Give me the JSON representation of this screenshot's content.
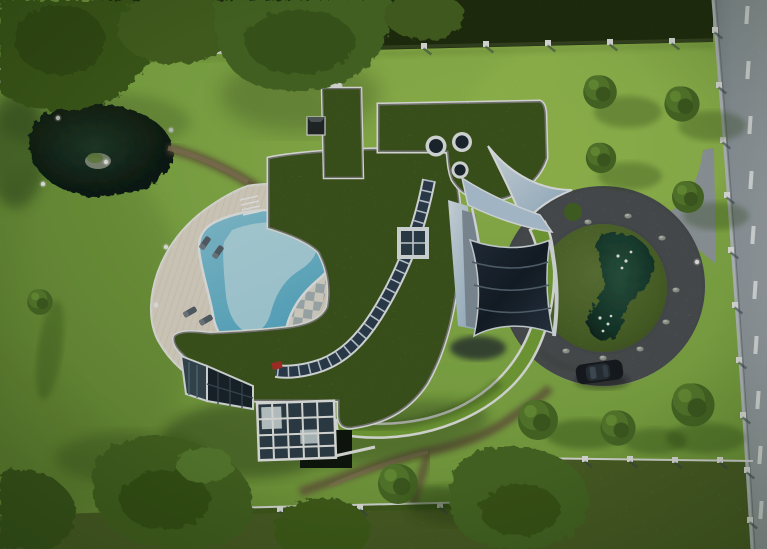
{
  "scene": {
    "kind": "aerial-architectural-render",
    "view": "top-down aerial view of a modern villa with curved green roofs, pool, circular driveway and road",
    "objects": [
      "green-roofed house with white parapet edges",
      "curved rooftop skylight band",
      "square rooftop skylight",
      "three round rooftop skylights",
      "dark solar-panel canopy sail",
      "free-form swimming pool with deck",
      "checkerboard terrace",
      "sun loungers",
      "white conservatory glass structure",
      "dark lower glass facade",
      "light-blue entrance walkway and ramp walls",
      "grey circular driveway around a planted mound",
      "kidney-shaped pond on driveway mound with white flowers",
      "dark parked car",
      "large dark garden pond with island and lamps",
      "brown garden paths",
      "lawns and rough meadow strips",
      "hedges, perimeter walls and fences with white posts",
      "large and small trees with cast shadows",
      "asphalt road with dashed lane markings and roadside fence"
    ]
  },
  "palette": {
    "lawn": "#88b44a",
    "lawnBright": "#a6ce58",
    "meadow": "#86aa42",
    "hedge": "#47621f",
    "treeDark": "#3c5a1e",
    "treeLight": "#6d9739",
    "roof": "#7aa93a",
    "roofEdge": "#f2f5ef",
    "deck": "#e9e2d2",
    "checkerLight": "#e8e4d8",
    "checkerDark": "#aebcbe",
    "poolWater": "#79c5dc",
    "poolShallow": "#cdecf3",
    "pondDark": "#101f16",
    "moundPond": "#1b4034",
    "asphalt": "#9ba4a8",
    "road": "#949da4",
    "marking": "#eef1f2",
    "path": "#7b6a4e",
    "glass": "#31434f",
    "frameWhite": "#eef2f4",
    "solar": "#1c2733",
    "entranceBlue": "#bcd3e4",
    "carBody": "#191d21",
    "rock": "#9aa096"
  }
}
